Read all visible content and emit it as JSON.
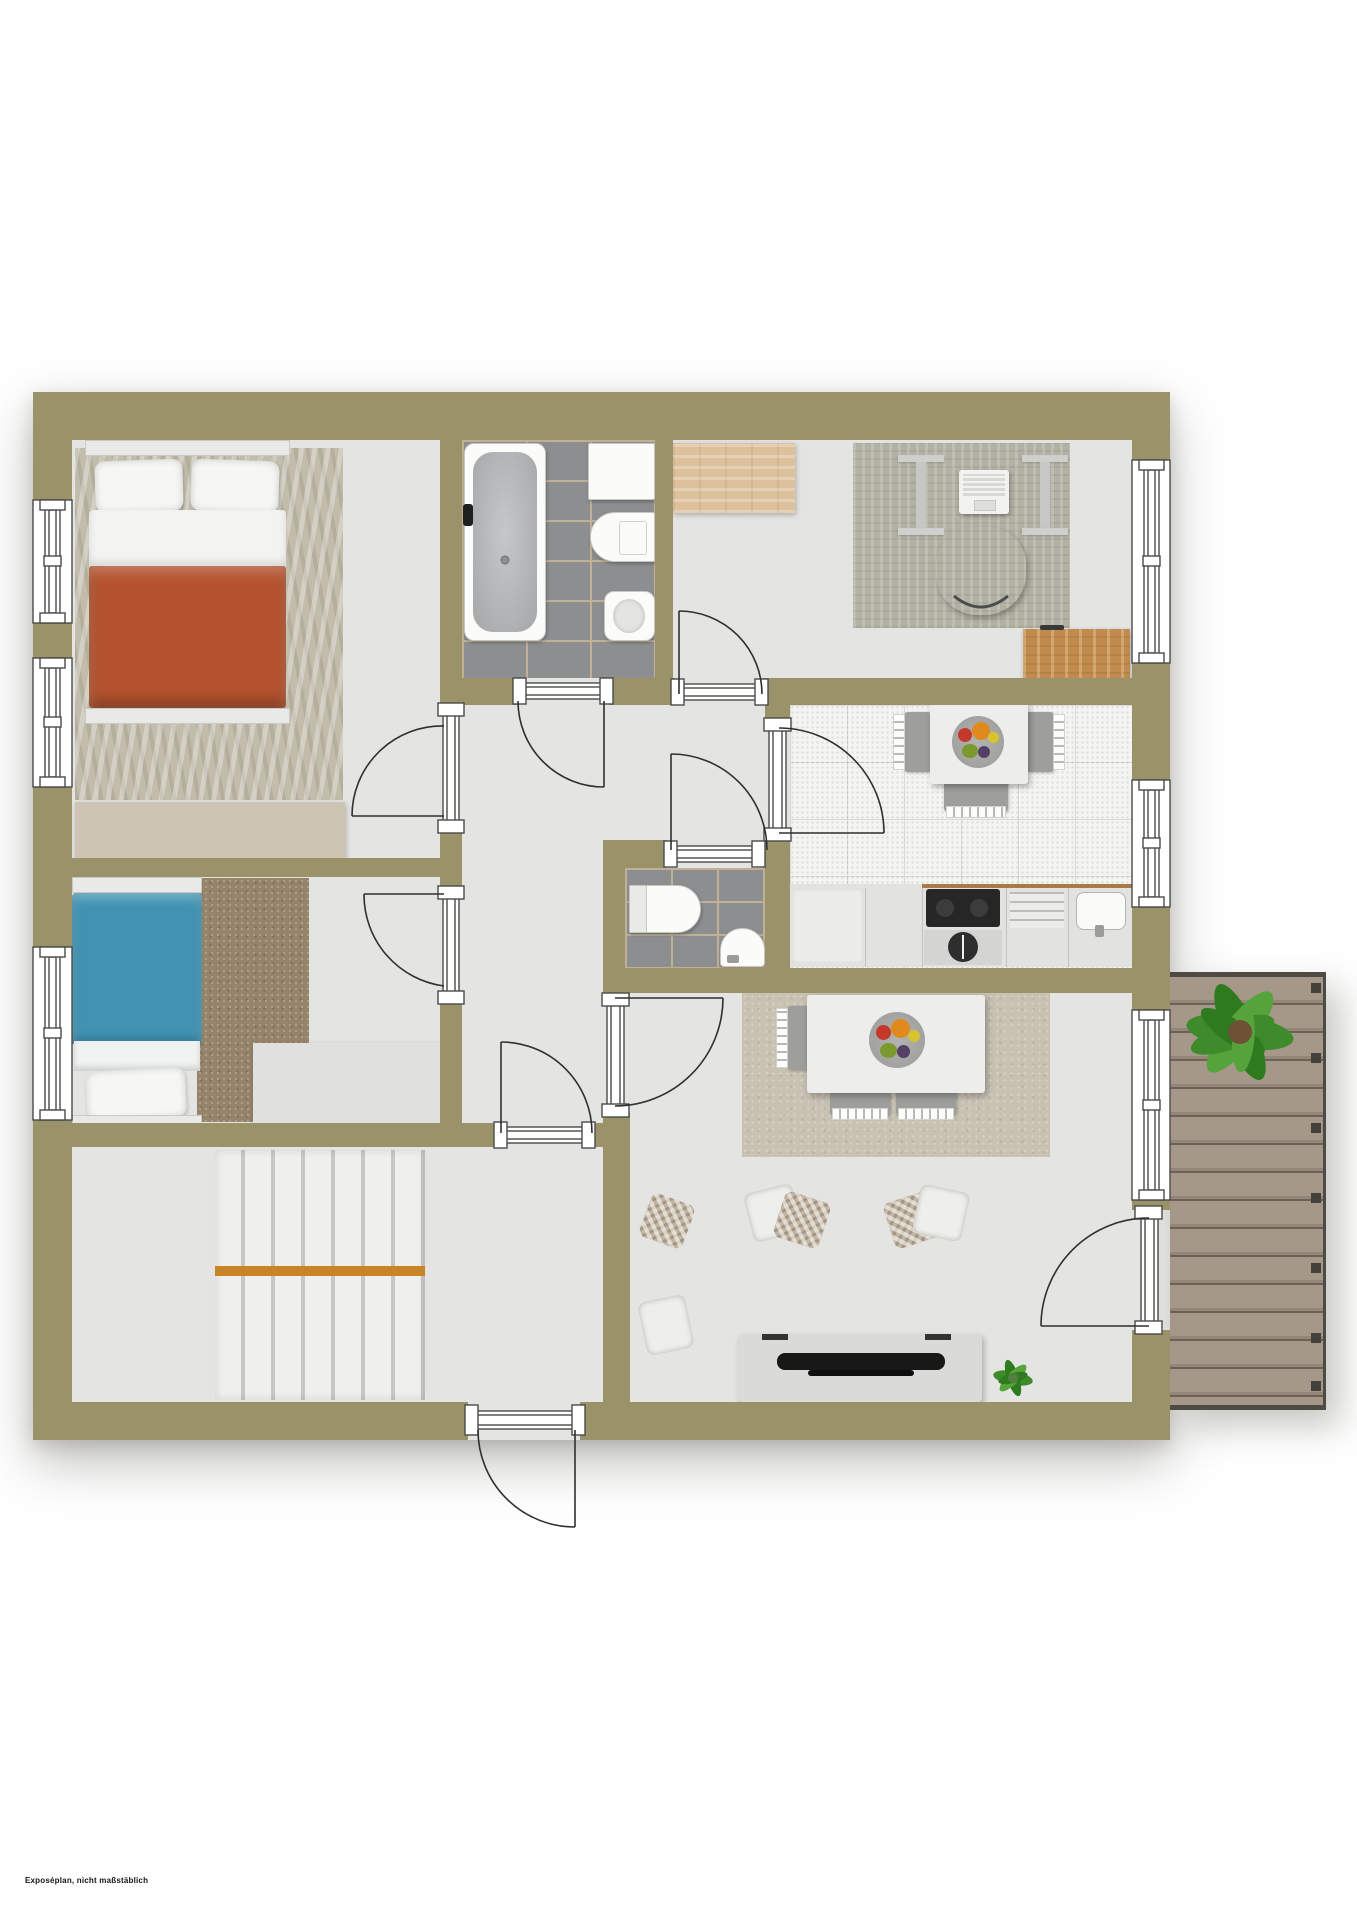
{
  "document": {
    "footnote": "Exposéplan, nicht maßstäblich"
  },
  "palette": {
    "wall": "#9a9369",
    "floor": "#e4e4e2",
    "bathTile": "#8d8e90",
    "bathGrout": "#bfb096",
    "kitchenTile": "#f4f4f2",
    "kitchenGrout": "#d9d9d7",
    "counter": "#e2e2e0",
    "cooktop": "#262626",
    "woodLight": "#ddc19c",
    "wood": "#c18b4e",
    "woodEdge": "#a87a45",
    "deckA": "#a59889",
    "deckB": "#93877a",
    "deckSeam": "#6b6257",
    "deckEdge": "#4e4a44",
    "bedOrange": "#b5532e",
    "bedBlue": "#4193b3",
    "rugMaster": "#c2bcab",
    "rugKids": "#95836a",
    "rugOffice": "#b2b2a4",
    "rugLiving": "#c8c2b3",
    "dresser": "#cdc4b4",
    "sofa": "#3f3f3d",
    "sofaSeam": "#2b2b29",
    "tvBoard": "#dadad8",
    "tv": "#181818",
    "rail": "#c98427",
    "stairTread": "#f0f0ee",
    "stairGap": "#c7c7c5",
    "plantGreen": "#3f8b2c",
    "plantGreenDark": "#2e7a1f",
    "plantGreenLight": "#57a33b"
  },
  "plan": {
    "type": "apartment-floor-plan",
    "rooms": [
      {
        "id": "master-bedroom",
        "items": [
          "double-bed",
          "pillows",
          "orange-duvet",
          "nightstand-with-lamp",
          "patterned-rug",
          "dresser"
        ]
      },
      {
        "id": "kids-room",
        "items": [
          "single-bed-blue",
          "shag-rug",
          "desk"
        ]
      },
      {
        "id": "bathroom",
        "items": [
          "bathtub",
          "washbasin",
          "toilet",
          "bidet",
          "gray-tiles"
        ]
      },
      {
        "id": "office",
        "items": [
          "wood-sideboard",
          "glass-desk",
          "laptop",
          "office-chair",
          "cabinet",
          "wood-desk",
          "rug"
        ]
      },
      {
        "id": "hallway",
        "items": []
      },
      {
        "id": "wc",
        "items": [
          "toilet",
          "corner-washbasin",
          "gray-tiles"
        ]
      },
      {
        "id": "kitchen",
        "items": [
          "dining-table",
          "fruit-bowl",
          "three-chairs",
          "counter",
          "cooktop",
          "oven",
          "sink",
          "white-tiles"
        ]
      },
      {
        "id": "staircase-room",
        "items": [
          "staircase",
          "orange-handrail"
        ]
      },
      {
        "id": "living-room",
        "items": [
          "dining-table",
          "fruit-bowl",
          "three-chairs",
          "corner-sofa",
          "throw-pillows",
          "tv-sideboard",
          "tv",
          "plant",
          "rug"
        ]
      },
      {
        "id": "balcony",
        "items": [
          "wood-decking",
          "large-plant"
        ]
      }
    ],
    "doors": [
      "master-bedroom-door",
      "kids-room-door",
      "bathroom-door",
      "office-door",
      "kitchen-door",
      "wc-door",
      "living-room-door",
      "stairs-door",
      "balcony-door",
      "entry-door"
    ],
    "windows": [
      "bedroom-window-1",
      "bedroom-window-2",
      "kids-room-window",
      "office-window",
      "kitchen-window",
      "living-room-window"
    ]
  }
}
